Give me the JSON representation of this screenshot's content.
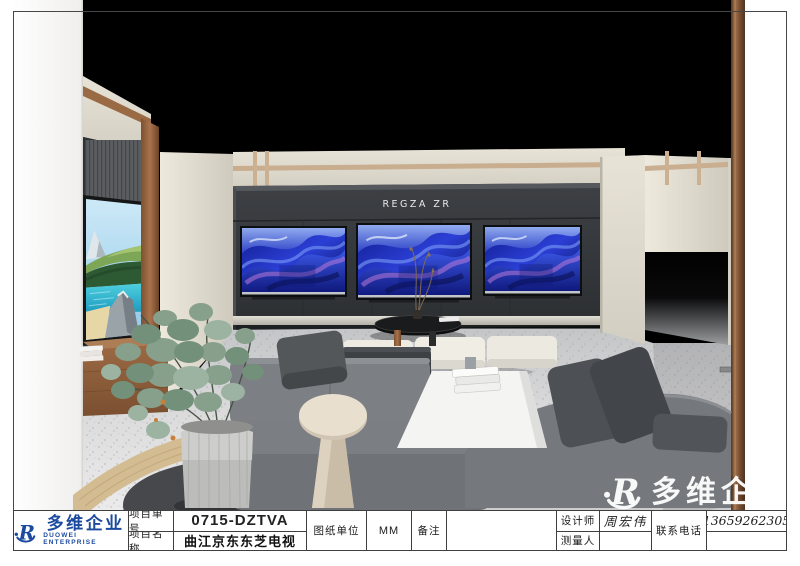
{
  "sheet": {
    "sign_text": "REGZA ZR",
    "watermark_text": "多维企业"
  },
  "title_block": {
    "logo": {
      "mark": "R",
      "cn": "多维企业",
      "en": "DUOWEI ENTERPRISE"
    },
    "project_no_label": "项目单号",
    "project_no_value": "0715-DZTVA",
    "project_name_label": "项目名称",
    "project_name_value": "曲江京东东芝电视",
    "unit_label": "图纸单位",
    "unit_value": "MM",
    "remark_label": "备注",
    "remark_value": "",
    "designer_label": "设计师",
    "designer_value": "周宏伟",
    "surveyor_label": "测量人",
    "surveyor_value": "",
    "phone_label": "联系电话",
    "phone_value": "13659262305"
  },
  "colors": {
    "accent_blue": "#1b4a9f",
    "frame": "#474747",
    "dark_wall": "#34373a",
    "cream_wall": "#ded9cd",
    "wood_trim": "#8a5a38",
    "tv_art_blue": "#2b3fd6"
  }
}
